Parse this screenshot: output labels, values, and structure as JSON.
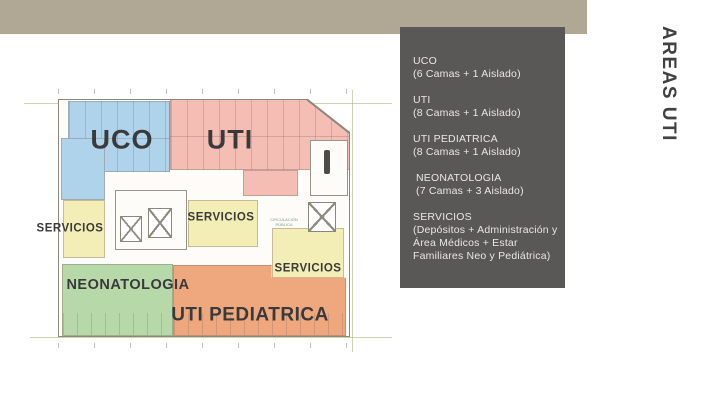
{
  "slide": {
    "background": "#ffffff",
    "top_bar_color": "#b1a795",
    "side_title": "AREAS UTI",
    "side_title_color": "#414141"
  },
  "info_panel": {
    "background": "#5a5757",
    "text_color": "#e9e7e4",
    "items": [
      {
        "title": "UCO",
        "detail": "(6 Camas + 1 Aislado)"
      },
      {
        "title": "UTI",
        "detail": "(8 Camas + 1 Aislado)"
      },
      {
        "title": "UTI PEDIATRICA",
        "detail": "(8 Camas + 1 Aislado)"
      },
      {
        "title": "NEONATOLOGIA",
        "detail": "(7 Camas + 3 Aislado)"
      },
      {
        "title": "SERVICIOS",
        "detail": "(Depósitos + Administración y Área Médicos + Estar Familiares Neo y Pediátrica)"
      }
    ]
  },
  "floor_plan": {
    "region_colors": {
      "uco": "#aed3ea",
      "uti": "#f5beb4",
      "servicios": "#f2eeb6",
      "neonatologia": "#b7d9aa",
      "uti_pediatrica": "#efa87e"
    },
    "labels": {
      "uco": "UCO",
      "uti": "UTI",
      "servicios_left": "SERVICIOS",
      "servicios_center": "SERVICIOS",
      "servicios_right": "SERVICIOS",
      "neonatologia": "NEONATOLOGIA",
      "uti_pediatrica": "UTI PEDIATRICA",
      "annotation_circulacion": "CIRCULACIÓN PÚBLICA"
    }
  }
}
